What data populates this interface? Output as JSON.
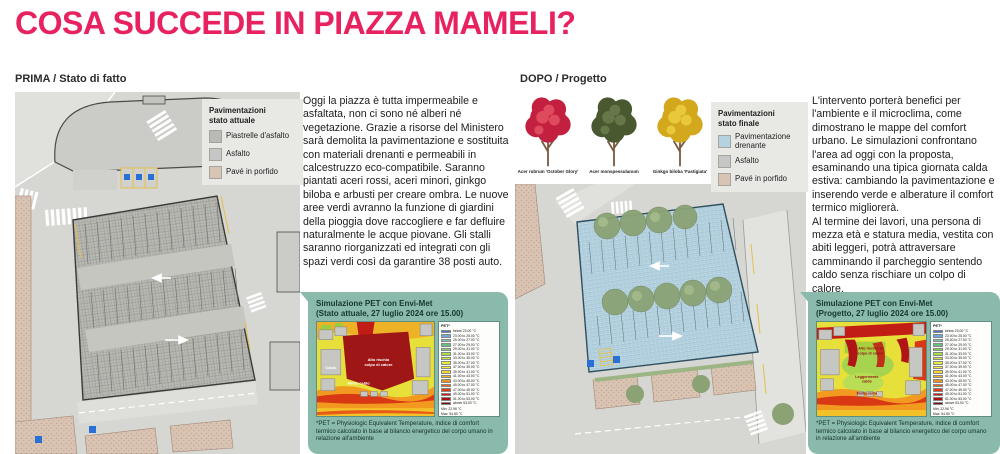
{
  "colors": {
    "accent": "#e8215f",
    "teal": "#8abaab",
    "map_bg": "#d6d6d3",
    "building": "#cbcbc7",
    "porfido": "#d9c3b2",
    "drain_blue": "#b5d2e0",
    "heat_yellow": "#e8e03a",
    "heat_darkred": "#9e1616"
  },
  "title": {
    "text": "COSA SUCCEDE IN PIAZZA MAMELI?"
  },
  "prima": {
    "header": "PRIMA / Stato di fatto",
    "legend": {
      "title_line1": "Pavimentazioni",
      "title_line2": "stato attuale",
      "items": [
        {
          "label": "Piastrelle d'asfalto",
          "color": "#b9b9b5",
          "pattern": "tiles"
        },
        {
          "label": "Asfalto",
          "color": "#c6c6c6",
          "pattern": "none"
        },
        {
          "label": "Pavé in porfido",
          "color": "#d9c3b2",
          "pattern": "dots"
        }
      ]
    },
    "paragraph": "Oggi la piazza è tutta impermeabile e asfaltata, non ci sono né alberi né vegetazione. Grazie a risorse del Ministero sarà demolita la pavimentazione e sostituita con materiali drenanti e permeabili in calcestruzzo eco-compatibile. Saranno piantati aceri rossi, aceri minori, ginkgo biloba e arbusti per creare ombra. Le nuove aree verdi avranno la funzione di giardini della pioggia dove raccogliere e far defluire naturalmente le acque piovane. Gli stalli saranno riorganizzati ed integrati con gli spazi verdi così da garantire 38 posti auto.",
    "sim": {
      "title": "Simulazione PET con Envi-Met",
      "subtitle": "(Stato attuale, 27 luglio 2024 ore 15.00)",
      "ann1a": "Alto rischio",
      "ann1b": "colpo di calore",
      "ann2": "Caldo",
      "ann3": "Molto caldo"
    }
  },
  "dopo": {
    "header": "DOPO / Progetto",
    "trees": [
      {
        "label": "Acer rubrum 'October Glory'",
        "color": "#c32040",
        "color2": "#e04a5e"
      },
      {
        "label": "Acer monspessulanum",
        "color": "#49582f",
        "color2": "#66774a"
      },
      {
        "label": "Ginkgo biloba 'Fastigiata'",
        "color": "#d3a81c",
        "color2": "#e9c93a"
      }
    ],
    "legend": {
      "title_line1": "Pavimentazioni",
      "title_line2": "stato finale",
      "items": [
        {
          "label": "Pavimentazione drenante",
          "color": "#b5d2e0",
          "pattern": "hatch"
        },
        {
          "label": "Asfalto",
          "color": "#c6c6c6",
          "pattern": "none"
        },
        {
          "label": "Pavé in porfido",
          "color": "#d9c3b2",
          "pattern": "dots"
        }
      ]
    },
    "paragraph": "L'intervento porterà benefici per l'ambiente e il microclima, come dimostrano le mappe del comfort urbano. Le simulazioni confrontano l'area ad oggi con la proposta, esaminando una tipica giornata calda estiva: cambiando la pavimentazione e inserendo verde e alberature il comfort termico migliorerà.\nAl termine dei lavori, una persona di mezza età e statura media, vestita con abiti leggeri, potrà attraversare camminando il parcheggio sentendo caldo senza rischiare un colpo di calore.",
    "sim": {
      "title": "Simulazione PET con Envi-Met",
      "subtitle": "(Progetto, 27 luglio 2024 ore 15.00)",
      "ann1a": "Alto rischio di",
      "ann1b": "colpo di calore",
      "ann2a": "Leggermente",
      "ann2b": "caldo",
      "ann3": "Molto caldo"
    }
  },
  "pet_scale": {
    "header": "PET*",
    "entries": [
      {
        "color": "#4f6fc8",
        "label": "below 23.00 °C"
      },
      {
        "color": "#6fa8dc",
        "label": "23.00 to 25.00 °C"
      },
      {
        "color": "#76c7b0",
        "label": "25.00 to 27.00 °C"
      },
      {
        "color": "#63bf7b",
        "label": "27.00 to 29.00 °C"
      },
      {
        "color": "#7ed957",
        "label": "29.00 to 31.00 °C"
      },
      {
        "color": "#a3e048",
        "label": "31.00 to 33.00 °C"
      },
      {
        "color": "#c6e83e",
        "label": "33.00 to 35.00 °C"
      },
      {
        "color": "#e4ef3c",
        "label": "35.00 to 37.00 °C"
      },
      {
        "color": "#f7f03a",
        "label": "37.00 to 39.00 °C"
      },
      {
        "color": "#f7d62e",
        "label": "39.00 to 41.00 °C"
      },
      {
        "color": "#f5b525",
        "label": "41.00 to 43.00 °C"
      },
      {
        "color": "#f0921e",
        "label": "43.00 to 45.00 °C"
      },
      {
        "color": "#e96a17",
        "label": "45.00 to 47.00 °C"
      },
      {
        "color": "#e03c12",
        "label": "47.00 to 49.00 °C"
      },
      {
        "color": "#cf1910",
        "label": "49.00 to 51.00 °C"
      },
      {
        "color": "#a81010",
        "label": "51.00 to 53.00 °C"
      },
      {
        "color": "#7e0a0a",
        "label": "above 53.00 °C"
      }
    ],
    "min": "Min: 22.96 °C",
    "max": "Max: 54.80 °C",
    "footnote": "*PET = Physiologic Equivalent Temperature, indice di comfort termico calcolato in base al bilancio energetico del corpo umano in relazione all'ambiente"
  }
}
